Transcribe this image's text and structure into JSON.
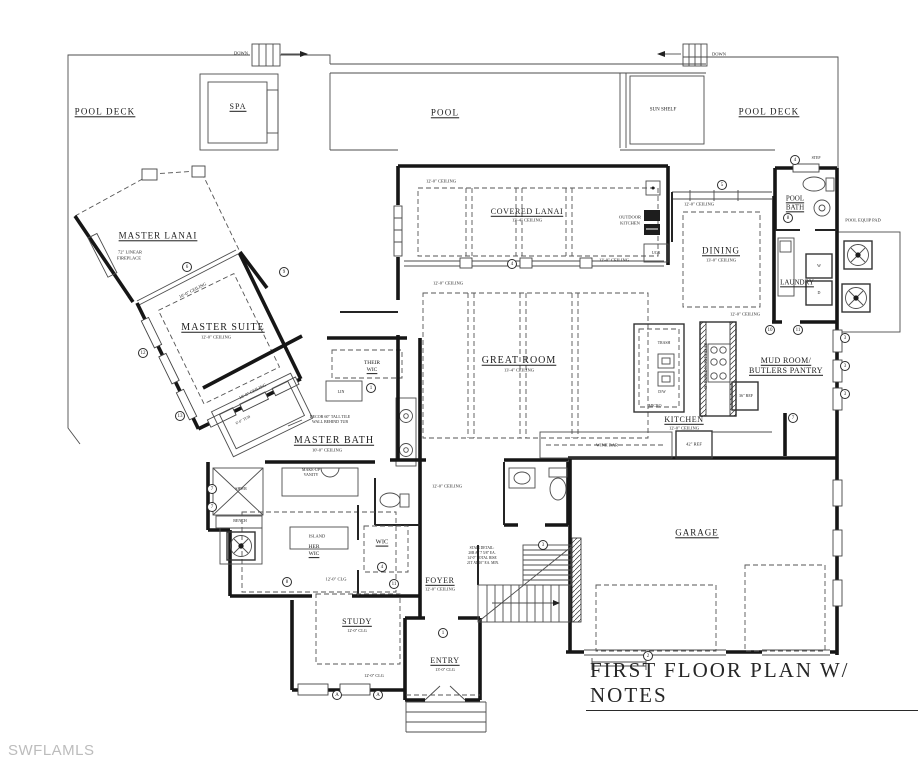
{
  "plan_title": "FIRST FLOOR PLAN W/ NOTES",
  "watermark": "SWFLAMLS",
  "colors": {
    "background": "#ffffff",
    "walls": "#161616",
    "thin_lines": "#4d4d4d",
    "watermark": "#bcbcbc",
    "text": "#1c1c1c"
  },
  "labels": [
    {
      "name": "pool-deck-left-label",
      "text": "POOL DECK",
      "x": 105,
      "y": 112,
      "s": 9,
      "u": true,
      "ls": 1.2
    },
    {
      "name": "spa-label",
      "text": "SPA",
      "x": 238,
      "y": 107,
      "s": 8,
      "u": true,
      "ls": 1
    },
    {
      "name": "pool-label",
      "text": "POOL",
      "x": 445,
      "y": 113,
      "s": 9,
      "u": true,
      "ls": 1.2
    },
    {
      "name": "sun-shelf-label",
      "text": "SUN SHELF",
      "x": 663,
      "y": 110,
      "s": 5
    },
    {
      "name": "pool-deck-right-label",
      "text": "POOL DECK",
      "x": 769,
      "y": 112,
      "s": 9,
      "u": true,
      "ls": 1.2
    },
    {
      "name": "down-left-label",
      "text": "DOWN",
      "x": 241,
      "y": 54,
      "s": 4.5
    },
    {
      "name": "down-right-label",
      "text": "DOWN",
      "x": 719,
      "y": 55,
      "s": 4.5
    },
    {
      "name": "master-lanai-label",
      "text": "MASTER LANAI",
      "x": 158,
      "y": 236,
      "s": 9,
      "u": true,
      "ls": 1
    },
    {
      "name": "fireplace-note-1",
      "text": "72\" LINEAR",
      "x": 130,
      "y": 253,
      "s": 4.5
    },
    {
      "name": "fireplace-note-2",
      "text": "FIREPLACE",
      "x": 129,
      "y": 259,
      "s": 4.5
    },
    {
      "name": "ceiling-10-a",
      "text": "10'-0\" CEILING",
      "x": 193,
      "y": 291,
      "s": 4.5,
      "r": -27
    },
    {
      "name": "master-suite-label",
      "text": "MASTER SUITE",
      "x": 223,
      "y": 328,
      "s": 10,
      "u": true,
      "ls": 1
    },
    {
      "name": "master-suite-clg",
      "text": "12'-0\" CEILING",
      "x": 216,
      "y": 338,
      "s": 4.5
    },
    {
      "name": "ceiling-10-b",
      "text": "10'-0\" CEILING",
      "x": 253,
      "y": 392,
      "s": 4.5,
      "r": -27
    },
    {
      "name": "covered-lanai-label",
      "text": "COVERED LANAI",
      "x": 527,
      "y": 212,
      "s": 8,
      "u": true,
      "ls": 0.6
    },
    {
      "name": "covered-lanai-clg",
      "text": "13'-4\" CEILING",
      "x": 527,
      "y": 221,
      "s": 4.5
    },
    {
      "name": "ceiling-12-a",
      "text": "12'-0\" CEILING",
      "x": 441,
      "y": 182,
      "s": 4.5
    },
    {
      "name": "ceiling-12-b",
      "text": "12'-0\" CEILING",
      "x": 614,
      "y": 261,
      "s": 4.5
    },
    {
      "name": "outdoor-kitchen-1",
      "text": "OUTDOOR",
      "x": 630,
      "y": 218,
      "s": 4.5
    },
    {
      "name": "outdoor-kitchen-2",
      "text": "KITCHEN",
      "x": 630,
      "y": 224,
      "s": 4.5
    },
    {
      "name": "ucr-label",
      "text": "UCR",
      "x": 656,
      "y": 253,
      "s": 4
    },
    {
      "name": "dining-label",
      "text": "DINING",
      "x": 721,
      "y": 251,
      "s": 9,
      "u": true,
      "ls": 1
    },
    {
      "name": "dining-clg",
      "text": "13'-0\" CEILING",
      "x": 721,
      "y": 261,
      "s": 4.5
    },
    {
      "name": "ceiling-12-c",
      "text": "12'-0\" CEILING",
      "x": 699,
      "y": 205,
      "s": 4.5
    },
    {
      "name": "ceiling-12-d",
      "text": "12'-0\" CEILING",
      "x": 745,
      "y": 315,
      "s": 4.5
    },
    {
      "name": "pool-bath-1",
      "text": "POOL",
      "x": 795,
      "y": 199,
      "s": 7,
      "u": true
    },
    {
      "name": "pool-bath-2",
      "text": "BATH",
      "x": 795,
      "y": 208,
      "s": 7,
      "u": true
    },
    {
      "name": "step-note",
      "text": "STEP",
      "x": 816,
      "y": 158,
      "s": 3.8
    },
    {
      "name": "pool-equip-pad-label",
      "text": "POOL EQUIP PAD",
      "x": 863,
      "y": 221,
      "s": 4.5
    },
    {
      "name": "laundry-label",
      "text": "LAUNDRY",
      "x": 797,
      "y": 283,
      "s": 7,
      "u": true
    },
    {
      "name": "washer-label",
      "text": "W",
      "x": 819,
      "y": 266,
      "s": 4
    },
    {
      "name": "dryer-label",
      "text": "D",
      "x": 819,
      "y": 293,
      "s": 4
    },
    {
      "name": "great-room-label",
      "text": "GREAT ROOM",
      "x": 519,
      "y": 361,
      "s": 10,
      "u": true,
      "ls": 1
    },
    {
      "name": "great-room-clg",
      "text": "13'-4\" CEILING",
      "x": 519,
      "y": 371,
      "s": 4.5
    },
    {
      "name": "ceiling-12-e",
      "text": "12'-0\" CEILING",
      "x": 448,
      "y": 284,
      "s": 4.5
    },
    {
      "name": "kitchen-label",
      "text": "KITCHEN",
      "x": 684,
      "y": 420,
      "s": 8,
      "u": true,
      "ls": 0.6
    },
    {
      "name": "kitchen-clg",
      "text": "12'-0\" CEILING",
      "x": 684,
      "y": 429,
      "s": 4.5
    },
    {
      "name": "mud-room-1",
      "text": "MUD ROOM/",
      "x": 786,
      "y": 361,
      "s": 8,
      "u": true,
      "ls": 0.4
    },
    {
      "name": "mud-room-2",
      "text": "BUTLERS PANTRY",
      "x": 786,
      "y": 371,
      "s": 8,
      "u": true,
      "ls": 0.4
    },
    {
      "name": "wine-bar-label",
      "text": "WINE BAR",
      "x": 607,
      "y": 446,
      "s": 4.5
    },
    {
      "name": "ref-42-label",
      "text": "42\" REF",
      "x": 694,
      "y": 445,
      "s": 4.5
    },
    {
      "name": "range-note",
      "text": "48\" RANGE W/ POT FILLER",
      "x": 706,
      "y": 366,
      "s": 3.8,
      "r": -90
    },
    {
      "name": "ref-36-label",
      "text": "36\" REF",
      "x": 746,
      "y": 396,
      "s": 4
    },
    {
      "name": "micro-label",
      "text": "MICRO",
      "x": 655,
      "y": 406,
      "s": 4
    },
    {
      "name": "dw-label",
      "text": "D/W",
      "x": 662,
      "y": 392,
      "s": 3.8
    },
    {
      "name": "trash-label",
      "text": "TRASH",
      "x": 664,
      "y": 343,
      "s": 3.8
    },
    {
      "name": "their-wic-1",
      "text": "THEIR",
      "x": 372,
      "y": 364,
      "s": 5.5
    },
    {
      "name": "their-wic-2",
      "text": "WIC",
      "x": 372,
      "y": 371,
      "s": 5.5,
      "u": true
    },
    {
      "name": "lin-label",
      "text": "LIN",
      "x": 341,
      "y": 392,
      "s": 4
    },
    {
      "name": "tub-note-1",
      "text": "DECOR 60\" TALL TILE",
      "x": 330,
      "y": 417,
      "s": 4
    },
    {
      "name": "tub-note-2",
      "text": "WALL BEHIND TUB",
      "x": 330,
      "y": 422,
      "s": 4
    },
    {
      "name": "tub-label",
      "text": "6'-0\" TUB",
      "x": 243,
      "y": 420,
      "s": 3.8,
      "r": -27
    },
    {
      "name": "master-bath-label",
      "text": "MASTER BATH",
      "x": 334,
      "y": 441,
      "s": 10,
      "u": true,
      "ls": 1
    },
    {
      "name": "master-bath-clg",
      "text": "10'-0\" CEILING",
      "x": 327,
      "y": 451,
      "s": 4.5
    },
    {
      "name": "makeup-1",
      "text": "MAKE-UP",
      "x": 311,
      "y": 470,
      "s": 4
    },
    {
      "name": "makeup-2",
      "text": "VANITY",
      "x": 311,
      "y": 475,
      "s": 4
    },
    {
      "name": "shwr-label",
      "text": "SHWR",
      "x": 241,
      "y": 489,
      "s": 4
    },
    {
      "name": "bench-label",
      "text": "BENCH",
      "x": 240,
      "y": 521,
      "s": 4
    },
    {
      "name": "island-label",
      "text": "ISLAND",
      "x": 317,
      "y": 537,
      "s": 4.5
    },
    {
      "name": "her-wic-1",
      "text": "HER",
      "x": 314,
      "y": 548,
      "s": 5.5
    },
    {
      "name": "her-wic-2",
      "text": "WIC",
      "x": 314,
      "y": 555,
      "s": 5.5,
      "u": true
    },
    {
      "name": "wic-label",
      "text": "WIC",
      "x": 382,
      "y": 543,
      "s": 6.5,
      "u": true
    },
    {
      "name": "clg-12-f",
      "text": "12'-0\" CLG",
      "x": 336,
      "y": 580,
      "s": 4.5
    },
    {
      "name": "clg-12-g",
      "text": "12'-0\" CEILING",
      "x": 447,
      "y": 487,
      "s": 4.5
    },
    {
      "name": "foyer-label",
      "text": "FOYER",
      "x": 440,
      "y": 581,
      "s": 8,
      "u": true,
      "ls": 0.6
    },
    {
      "name": "foyer-clg",
      "text": "12'-0\" CEILING",
      "x": 440,
      "y": 590,
      "s": 4.5
    },
    {
      "name": "stair-note-1",
      "text": "STAIR DETAIL:",
      "x": 482,
      "y": 549,
      "s": 3.6
    },
    {
      "name": "stair-note-2",
      "text": "20R AT 7 5/8\" EA.",
      "x": 482,
      "y": 554,
      "s": 3.6
    },
    {
      "name": "stair-note-3",
      "text": "14'-0\" TOTAL RISE",
      "x": 482,
      "y": 559,
      "s": 3.6
    },
    {
      "name": "stair-note-4",
      "text": "21T AT 10\" EA. MIN.",
      "x": 483,
      "y": 564,
      "s": 3.6
    },
    {
      "name": "study-label",
      "text": "STUDY",
      "x": 357,
      "y": 622,
      "s": 8,
      "u": true,
      "ls": 0.6
    },
    {
      "name": "study-clg",
      "text": "12'-0\" CLG",
      "x": 357,
      "y": 631,
      "s": 4.2
    },
    {
      "name": "clg-12-h",
      "text": "12'-0\" CLG",
      "x": 374,
      "y": 676,
      "s": 4.2
    },
    {
      "name": "entry-label",
      "text": "ENTRY",
      "x": 445,
      "y": 661,
      "s": 8,
      "u": true,
      "ls": 0.6
    },
    {
      "name": "entry-clg",
      "text": "13'-0\" CLG",
      "x": 445,
      "y": 670,
      "s": 4.2
    },
    {
      "name": "garage-label",
      "text": "GARAGE",
      "x": 697,
      "y": 533,
      "s": 9,
      "u": true,
      "ls": 1
    }
  ],
  "markers": [
    {
      "label": "6",
      "x": 187,
      "y": 267
    },
    {
      "label": "9",
      "x": 284,
      "y": 272
    },
    {
      "label": "12",
      "x": 143,
      "y": 353
    },
    {
      "label": "13",
      "x": 180,
      "y": 416
    },
    {
      "label": "4",
      "x": 512,
      "y": 264
    },
    {
      "label": "5",
      "x": 722,
      "y": 185
    },
    {
      "label": "8",
      "x": 788,
      "y": 218
    },
    {
      "label": "4",
      "x": 795,
      "y": 160
    },
    {
      "label": "3",
      "x": 845,
      "y": 338
    },
    {
      "label": "3",
      "x": 845,
      "y": 366
    },
    {
      "label": "3",
      "x": 845,
      "y": 394
    },
    {
      "label": "10",
      "x": 770,
      "y": 330
    },
    {
      "label": "11",
      "x": 798,
      "y": 330
    },
    {
      "label": "7",
      "x": 212,
      "y": 489
    },
    {
      "label": "7",
      "x": 212,
      "y": 507
    },
    {
      "label": "8",
      "x": 287,
      "y": 582
    },
    {
      "label": "4",
      "x": 382,
      "y": 567
    },
    {
      "label": "11",
      "x": 394,
      "y": 584
    },
    {
      "label": "A",
      "x": 337,
      "y": 695
    },
    {
      "label": "A",
      "x": 378,
      "y": 695
    },
    {
      "label": "1",
      "x": 443,
      "y": 633
    },
    {
      "label": "2",
      "x": 648,
      "y": 656
    },
    {
      "label": "3",
      "x": 543,
      "y": 545
    },
    {
      "label": "7",
      "x": 793,
      "y": 418
    },
    {
      "label": "1",
      "x": 371,
      "y": 388
    }
  ]
}
